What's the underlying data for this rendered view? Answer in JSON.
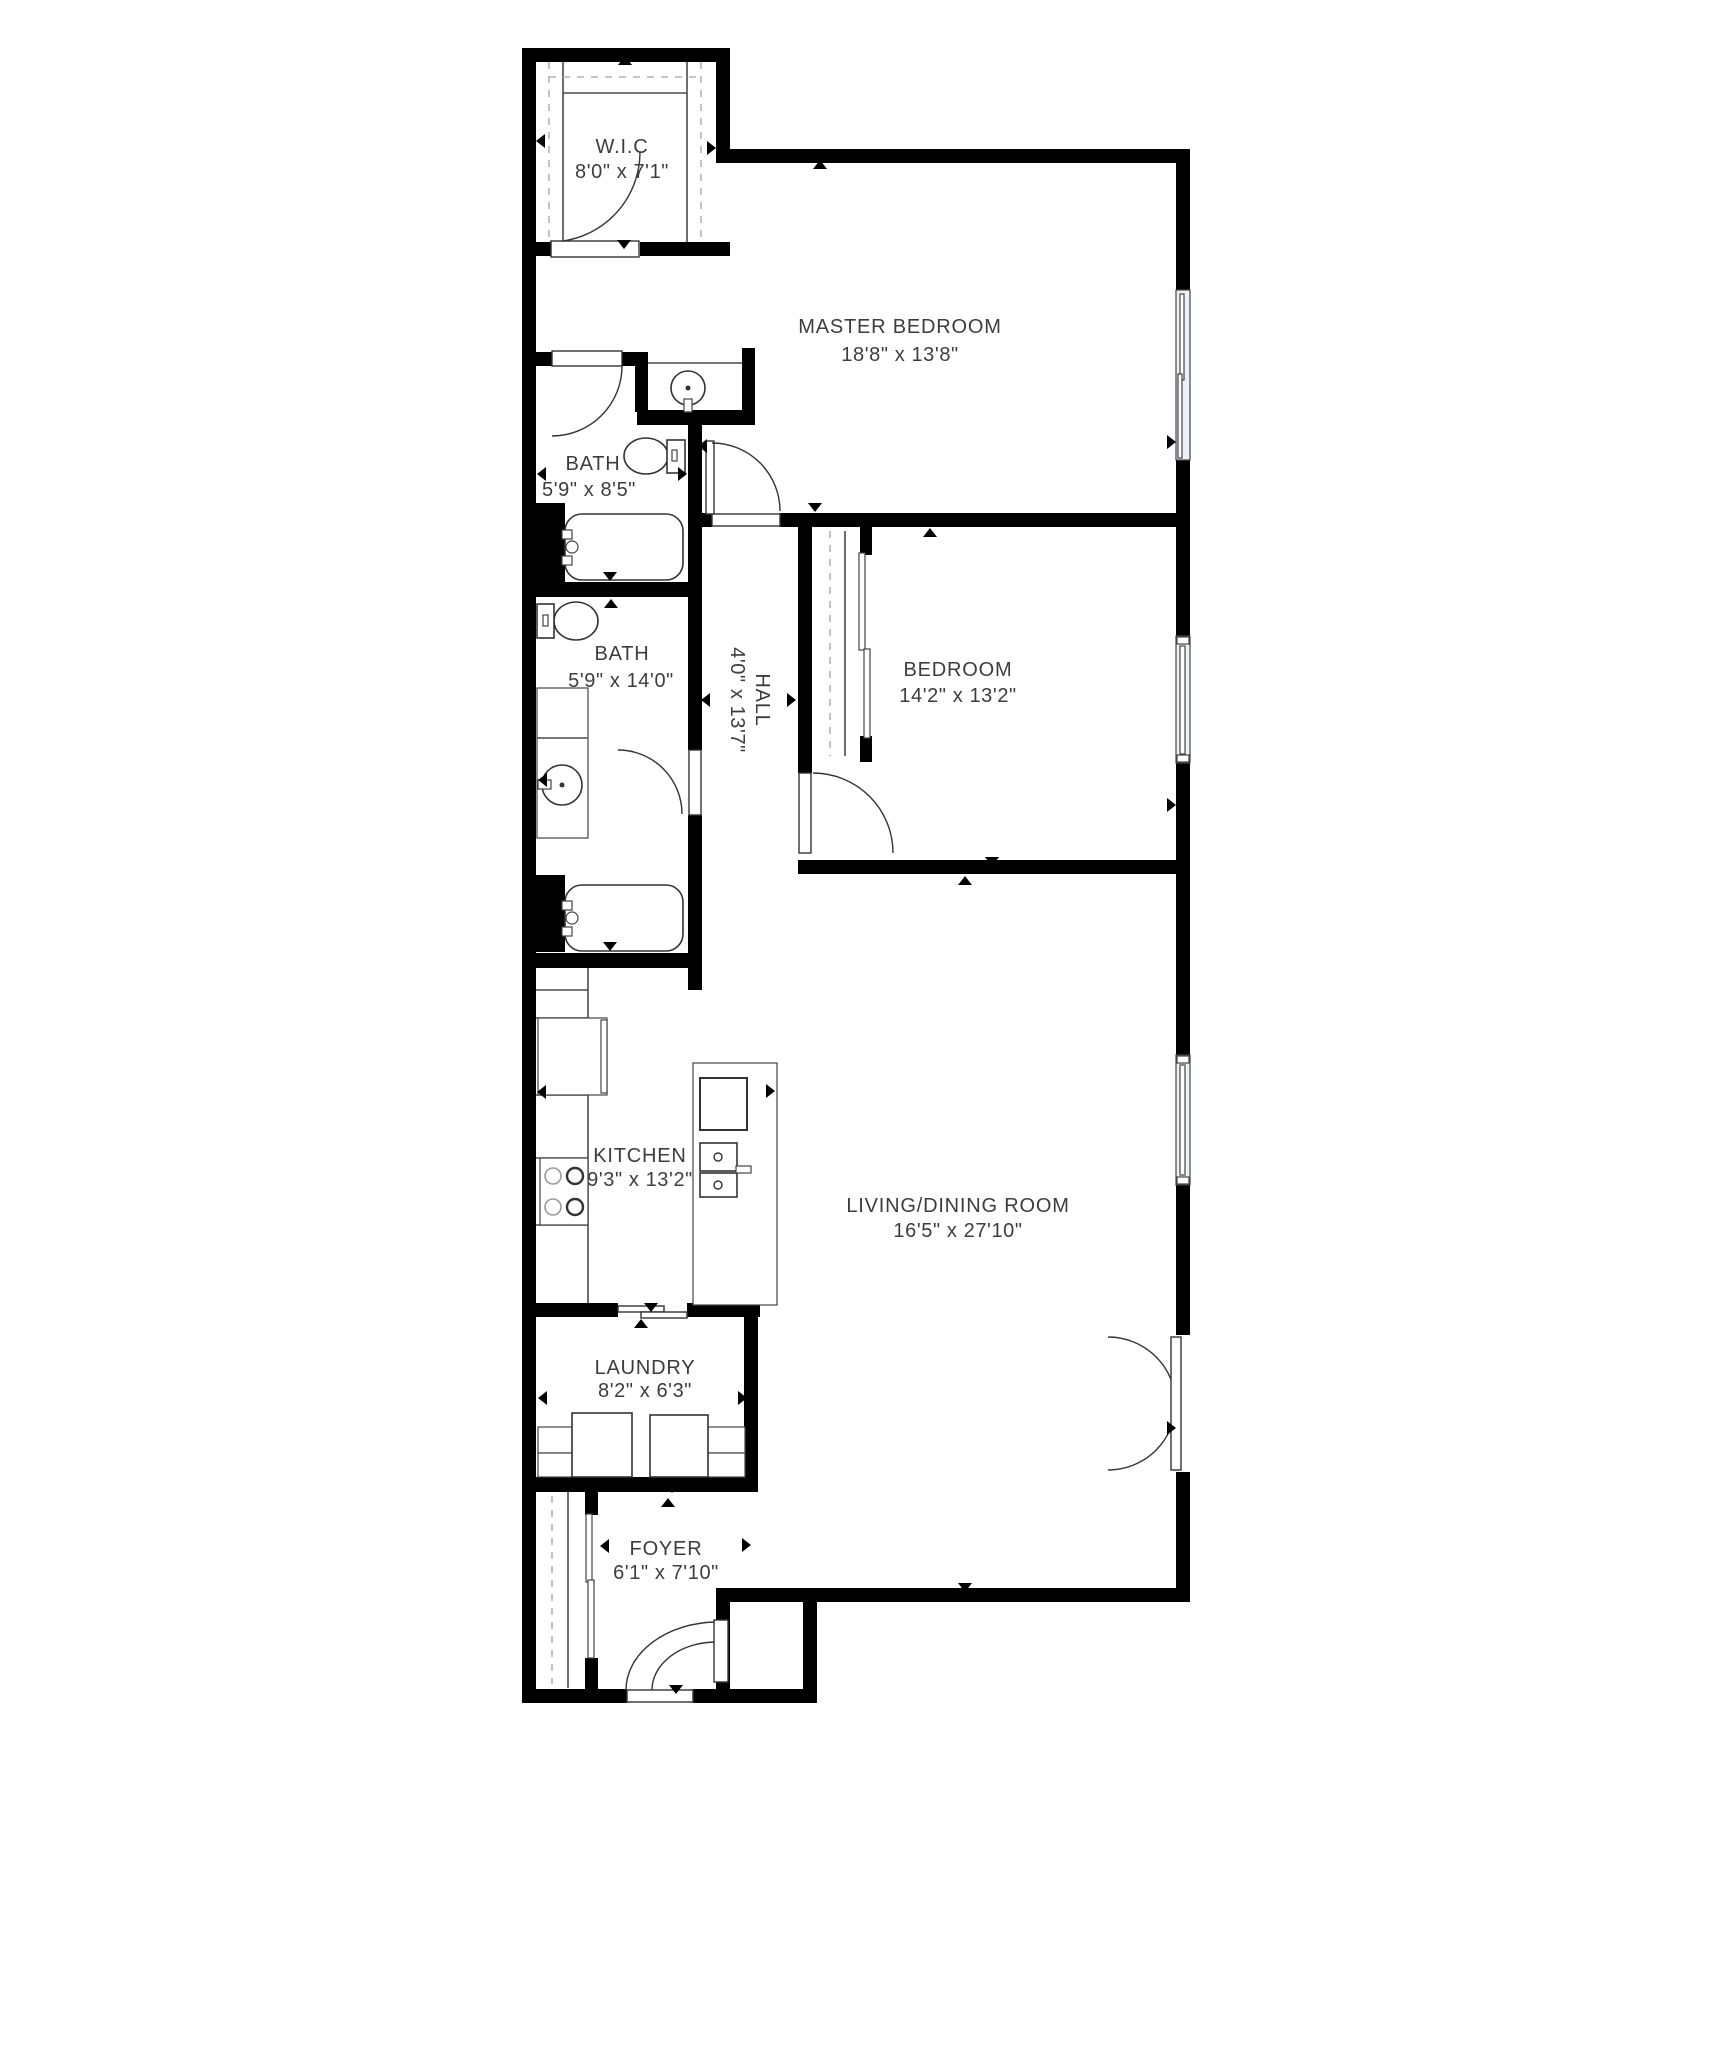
{
  "title": "Apartment floor plan",
  "colors": {
    "background": "#ffffff",
    "walls": "#000000",
    "fixture_lines": "#333333",
    "closet_dash": "#b3b3b3",
    "window_fill": "#edf0f8",
    "label_text": "#3d3d3d"
  },
  "rooms": [
    {
      "id": "wic",
      "name": "W.I.C",
      "dims": "8'0\" x 7'1\""
    },
    {
      "id": "master-bedroom",
      "name": "MASTER BEDROOM",
      "dims": "18'8\" x 13'8\""
    },
    {
      "id": "bath-1",
      "name": "BATH",
      "dims": "5'9\" x 8'5\""
    },
    {
      "id": "bath-2",
      "name": "BATH",
      "dims": "5'9\" x 14'0\""
    },
    {
      "id": "hall",
      "name": "HALL",
      "dims": "4'0\" x 13'7\""
    },
    {
      "id": "bedroom",
      "name": "BEDROOM",
      "dims": "14'2\" x 13'2\""
    },
    {
      "id": "kitchen",
      "name": "KITCHEN",
      "dims": "9'3\" x 13'2\""
    },
    {
      "id": "living-dining",
      "name": "LIVING/DINING ROOM",
      "dims": "16'5\" x 27'10\""
    },
    {
      "id": "laundry",
      "name": "LAUNDRY",
      "dims": "8'2\" x 6'3\""
    },
    {
      "id": "foyer",
      "name": "FOYER",
      "dims": "6'1\" x 7'10\""
    }
  ],
  "fixtures": [
    "toilet-icon",
    "toilet-icon",
    "bathtub-icon",
    "bathtub-icon",
    "pedestal-sink-icon",
    "vanity-sink-icon",
    "kitchen-sink-icon",
    "stove-icon",
    "fridge-icon",
    "kitchen-island",
    "washer-icon",
    "dryer-icon",
    "closet-rod",
    "sliding-door",
    "swing-door",
    "double-entry-door",
    "french-door",
    "window",
    "window",
    "window"
  ]
}
